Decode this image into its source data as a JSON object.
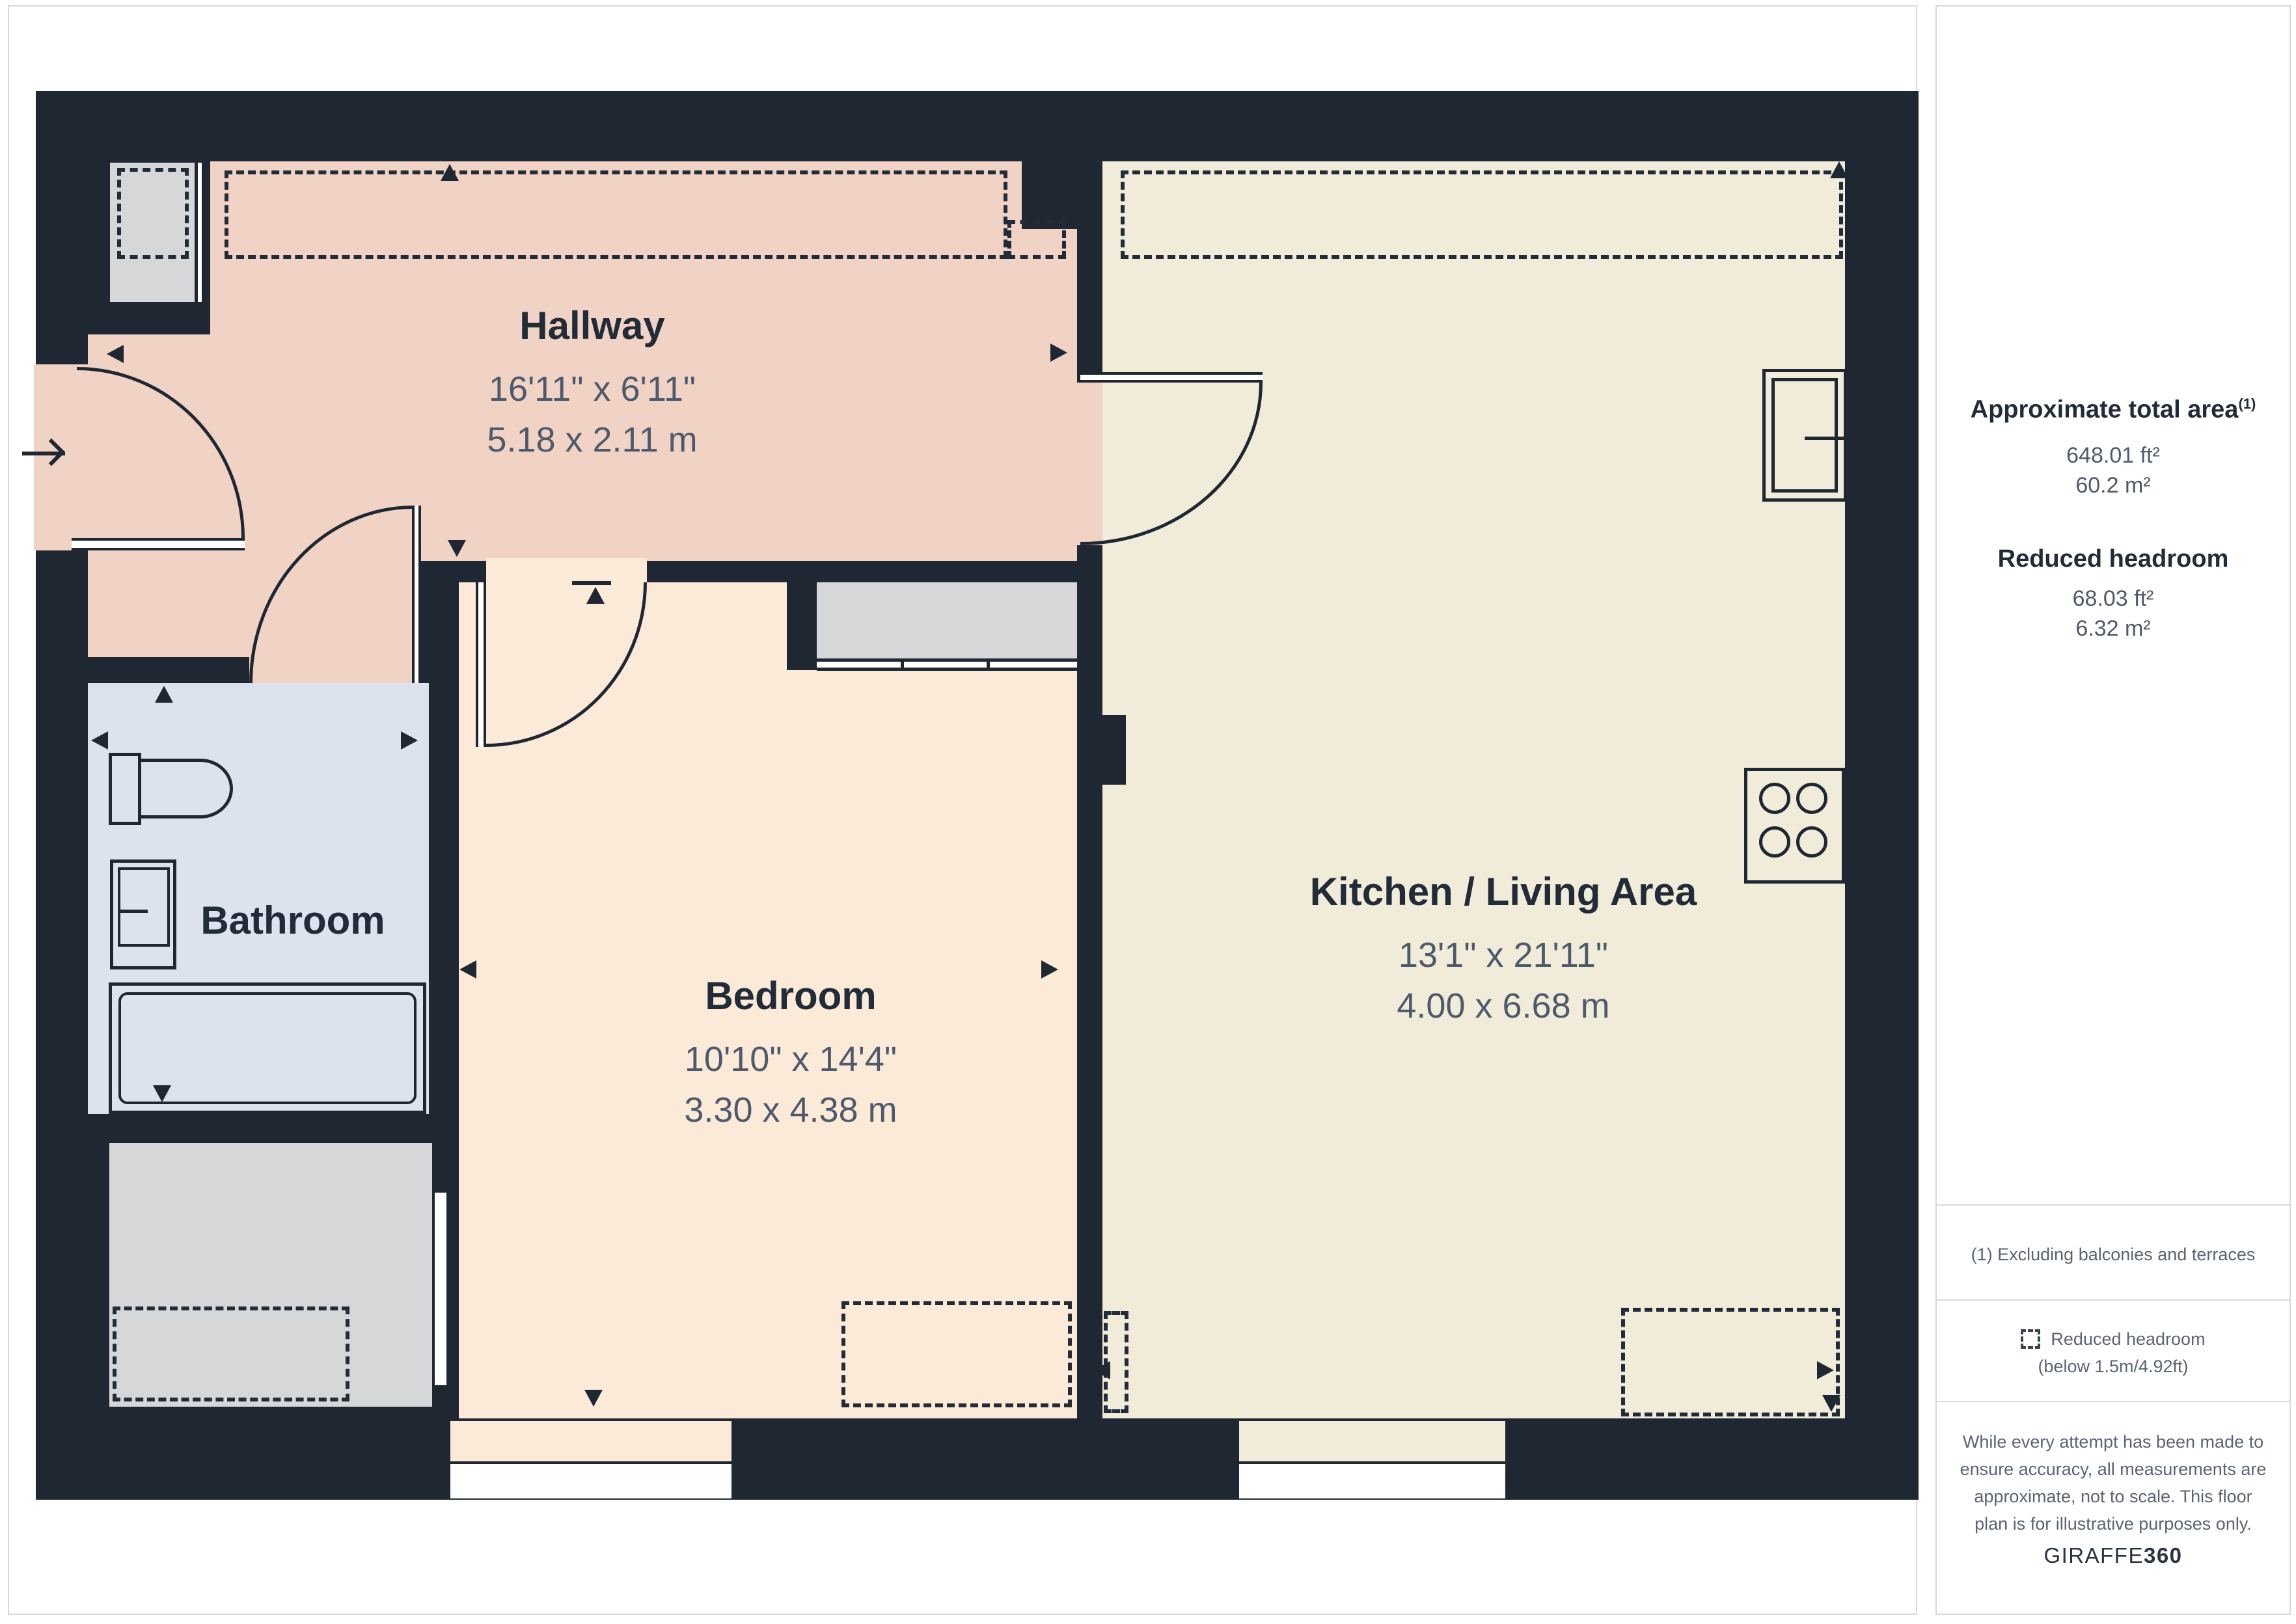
{
  "rooms": {
    "hallway": {
      "name": "Hallway",
      "dims_imperial": "16'11\" x 6'11\"",
      "dims_metric": "5.18 x 2.11 m"
    },
    "bathroom": {
      "name": "Bathroom"
    },
    "bedroom": {
      "name": "Bedroom",
      "dims_imperial": "10'10\" x 14'4\"",
      "dims_metric": "3.30 x 4.38 m"
    },
    "kitchen": {
      "name": "Kitchen / Living Area",
      "dims_imperial": "13'1\" x 21'11\"",
      "dims_metric": "4.00 x 6.68 m"
    }
  },
  "sidebar": {
    "total_area": {
      "title": "Approximate total area",
      "footnote_marker": "(1)",
      "value_ft": "648.01 ft²",
      "value_m": "60.2 m²"
    },
    "reduced_headroom": {
      "title": "Reduced headroom",
      "value_ft": "68.03 ft²",
      "value_m": "6.32 m²"
    },
    "footnote": "(1) Excluding balconies and terraces",
    "legend": {
      "line1": "Reduced headroom",
      "line2": "(below 1.5m/4.92ft)"
    },
    "disclaimer": [
      "While every attempt has been made to",
      "ensure accuracy, all measurements are",
      "approximate, not to scale. This floor",
      "plan is for illustrative purposes only."
    ],
    "brand": {
      "name": "GIRAFFE",
      "suffix": "360"
    }
  },
  "colors": {
    "wall": "#1f2733",
    "hallway": "#f0d3c4",
    "bedroom": "#fcead9",
    "kitchen": "#f0ecd9",
    "bathroom": "#dde2ef",
    "storage_gray": "#d5d7d8",
    "dim_text": "#4e596b",
    "panel_border": "#d8d8d8"
  }
}
